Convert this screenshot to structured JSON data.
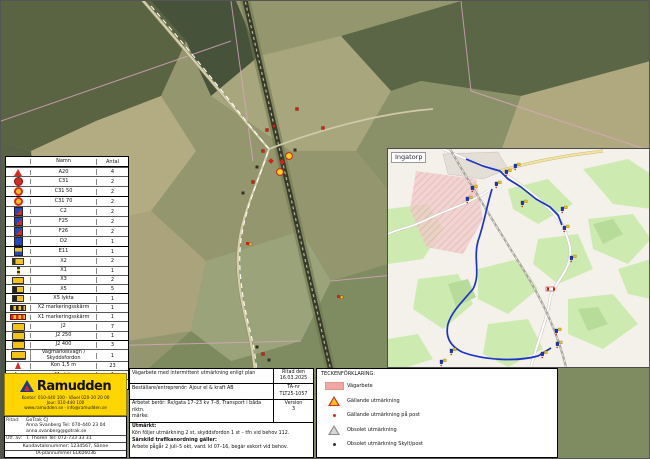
{
  "legend_table": {
    "headers": [
      "",
      "Namn",
      "Antal"
    ],
    "rows": [
      {
        "icon": "tri-warn",
        "name": "A20",
        "qty": "4"
      },
      {
        "icon": "circ-red",
        "name": "C31",
        "qty": "2"
      },
      {
        "icon": "circ-speed",
        "name": "C31 50",
        "qty": "2"
      },
      {
        "icon": "circ-speed",
        "name": "C31 70",
        "qty": "2"
      },
      {
        "icon": "sq-bluered",
        "name": "C2",
        "qty": "2"
      },
      {
        "icon": "sq-bluered",
        "name": "F25",
        "qty": "2"
      },
      {
        "icon": "sq-bluered",
        "name": "F26",
        "qty": "2"
      },
      {
        "icon": "sq-blue",
        "name": "D2",
        "qty": "1"
      },
      {
        "icon": "sq-yelblue",
        "name": "E11",
        "qty": "1"
      },
      {
        "icon": "rect-arrow",
        "name": "X2",
        "qty": "2"
      },
      {
        "icon": "pole",
        "name": "X1",
        "qty": "1"
      },
      {
        "icon": "rect-yellow",
        "name": "X3",
        "qty": "2"
      },
      {
        "icon": "rect-darkyel",
        "name": "X5",
        "qty": "5"
      },
      {
        "icon": "rect-darkyel",
        "name": "X5 lykta",
        "qty": "1"
      },
      {
        "icon": "bar-dark",
        "name": "X2 markeringsskärm",
        "qty": "1"
      },
      {
        "icon": "bar-red",
        "name": "X1 markeringsskärm",
        "qty": "1"
      },
      {
        "icon": "sign-yel",
        "name": "J2",
        "qty": "7"
      },
      {
        "icon": "sign-yel",
        "name": "J2 250",
        "qty": "1"
      },
      {
        "icon": "sign-yel",
        "name": "J2 400",
        "qty": "3"
      },
      {
        "icon": "trailer",
        "name": "Vägmärkesvagn / Skyddsfordon",
        "qty": "1"
      },
      {
        "icon": "cone",
        "name": "Kon 1,5 m",
        "qty": "23"
      },
      {
        "icon": "flag",
        "name": "Markör",
        "qty": "1"
      },
      {
        "icon": "person",
        "name": "Personal",
        "qty": "5"
      }
    ]
  },
  "inset": {
    "label": "Ingatorp",
    "markers": [
      {
        "x": 117,
        "y": 21,
        "t": "pair"
      },
      {
        "x": 126,
        "y": 15,
        "t": "pair"
      },
      {
        "x": 107,
        "y": 33,
        "t": "pair"
      },
      {
        "x": 83,
        "y": 37,
        "t": "pair"
      },
      {
        "x": 78,
        "y": 48,
        "t": "pair"
      },
      {
        "x": 133,
        "y": 52,
        "t": "pair"
      },
      {
        "x": 173,
        "y": 58,
        "t": "pair"
      },
      {
        "x": 175,
        "y": 77,
        "t": "pair"
      },
      {
        "x": 182,
        "y": 107,
        "t": "pair"
      },
      {
        "x": 158,
        "y": 138,
        "t": "barrier"
      },
      {
        "x": 167,
        "y": 180,
        "t": "pair"
      },
      {
        "x": 168,
        "y": 193,
        "t": "pair"
      },
      {
        "x": 153,
        "y": 203,
        "t": "pair"
      },
      {
        "x": 62,
        "y": 200,
        "t": "pair"
      },
      {
        "x": 52,
        "y": 211,
        "t": "pair"
      }
    ]
  },
  "aerial": {
    "markers": [
      {
        "x": 266,
        "y": 129,
        "t": "red"
      },
      {
        "x": 273,
        "y": 125,
        "t": "red"
      },
      {
        "x": 296,
        "y": 108,
        "t": "red"
      },
      {
        "x": 322,
        "y": 127,
        "t": "red"
      },
      {
        "x": 288,
        "y": 155,
        "t": "yc"
      },
      {
        "x": 279,
        "y": 171,
        "t": "yc"
      },
      {
        "x": 262,
        "y": 150,
        "t": "red"
      },
      {
        "x": 270,
        "y": 160,
        "t": "redx"
      },
      {
        "x": 281,
        "y": 161,
        "t": "redx"
      },
      {
        "x": 256,
        "y": 166,
        "t": "dark"
      },
      {
        "x": 294,
        "y": 149,
        "t": "dark"
      },
      {
        "x": 252,
        "y": 181,
        "t": "red"
      },
      {
        "x": 242,
        "y": 192,
        "t": "dark"
      },
      {
        "x": 247,
        "y": 243,
        "t": "redy"
      },
      {
        "x": 338,
        "y": 296,
        "t": "redy"
      },
      {
        "x": 256,
        "y": 346,
        "t": "dark"
      },
      {
        "x": 262,
        "y": 353,
        "t": "red"
      },
      {
        "x": 268,
        "y": 359,
        "t": "dark"
      }
    ]
  },
  "brand": {
    "name": "Ramudden",
    "addr1": "Kontor: 010-440 100 · Växel 020-20 20 00",
    "addr2": "Jour: 010-440 100",
    "addr3": "www.ramudden.se · info@ramudden.se",
    "row1_label": "Ritad:",
    "row1_line1": "GoTrak CJ",
    "row1_line2": "Anna Svanberg Tel: 070-440 23 04",
    "row1_line3": "anna.svanberg@gotrak.se",
    "row2_label": "Utf. av:",
    "row2_line1": "T. Thoren Tel: 072-733 33 31",
    "row3": "Kundavtalsnummer: 1234567, Sänne",
    "row4": "TA-plannummer ELK0603b"
  },
  "title_block": {
    "row1_text": "Vägarbete med intermittent utmärkning enligt plan",
    "row1_side_label": "Ritad den",
    "row1_side_value": "16.03.2025",
    "row2_text": "Beställare/entreprenör: Ajour el & kraft AB",
    "row2_side_label": "TA-nr",
    "row2_side_value": "TLT25-1057",
    "row3_line1": "Arbetet berör: Rv/gata 17–23 kv 7–8, Transport i båda riktn.",
    "row3_line2": "märke:",
    "row3_side_label": "Version",
    "row3_side_value": "3",
    "notes_title": "Utmärkt:",
    "notes": [
      "Kön följer utmärkning 2 st, skyddsfordon 1 st – tfn vid behov 112.",
      "Särskild trafikanordning gäller:",
      "Arbete pågår 2 juli–5 okt, vard. kl 07–16, begär eskort vid behov."
    ]
  },
  "symbol_legend": {
    "title": "TECKENFÖRKLARING:",
    "items": [
      {
        "icon": "area-pink",
        "label": "Vägarbete"
      },
      {
        "icon": "warn-tri",
        "label": "Gällande utmärkning"
      },
      {
        "icon": "dot-red",
        "label": "Gällande utmärkning på post"
      },
      {
        "icon": "gray-tri",
        "label": "Obsolet utmärkning"
      },
      {
        "icon": "dot-dark",
        "label": "Obsolet utmärkning Skylt/post"
      }
    ]
  },
  "colors": {
    "brand_yellow": "#FFD500",
    "route_blue": "#1d33c8",
    "work_area_pink": "#f2a6a6",
    "sign_red": "#d92b1d",
    "sign_yellow": "#f3c31a"
  }
}
